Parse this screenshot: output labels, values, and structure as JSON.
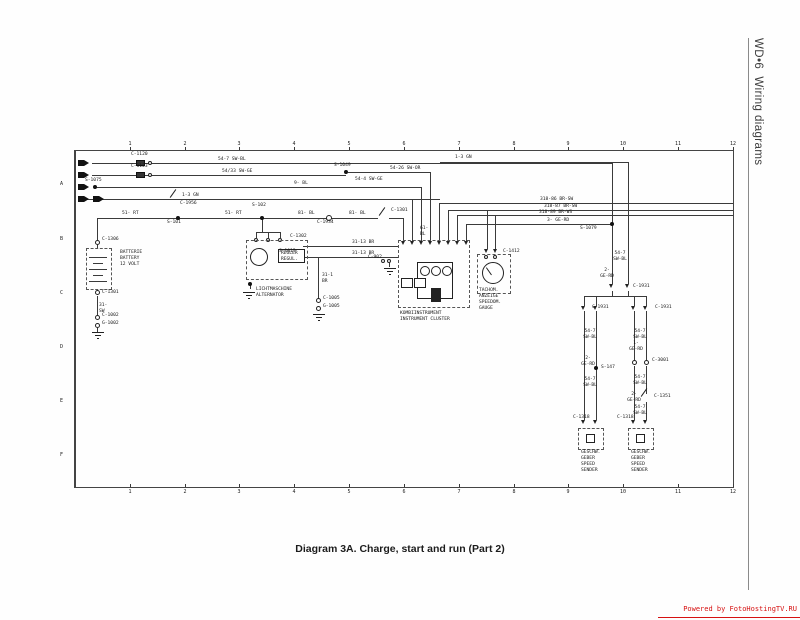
{
  "page": {
    "sidebar_title": "WD•6  Wiring diagrams",
    "caption": "Diagram 3A. Charge, start and run (Part 2)",
    "watermark": "Powered by FotoHostingTV.RU"
  },
  "grid": {
    "cols": [
      "1",
      "2",
      "3",
      "4",
      "5",
      "6",
      "7",
      "8",
      "9",
      "10",
      "11",
      "12"
    ],
    "rows": [
      "A",
      "B",
      "C",
      "D",
      "E",
      "F"
    ]
  },
  "labels": [
    "C-1120",
    "C-1123",
    "S-1075",
    "54-7 SW-BL",
    "54/33 SW-GE",
    "9- BL",
    "1-3 GN",
    "C-1956",
    "1-3 GN",
    "S-1049",
    "54-26 SW-OR",
    "54-4 SW-GE",
    "51- RT",
    "S-101",
    "51- RT",
    "S-102",
    "81- BL",
    "C-1934",
    "81- BL",
    "C-1301",
    "61-\nBL",
    "31-13 BR",
    "31-13 BR",
    "S-1015",
    "31-1\nBR",
    "C-1005",
    "G-1005",
    "C-1306",
    "BATTERIE\nBATTERY\n12 VOLT",
    "C-1301",
    "31-\nSW",
    "C-1002",
    "G-1002",
    "C-1302",
    "REGLER\nREGUL.",
    "LICHTMASCHINE\nALTERNATOR",
    "C-902",
    "KOMBIINSTRUMENT\nINSTRUMENT CLUSTER",
    "C-1412",
    "TACHOM.\nANZEIGE\nSPEEDOM.\nGAUGE",
    "318-86 BR-SW",
    "318-87 BR-SW",
    "318-89 BR-WS",
    "3- GE-RD",
    "S-1079",
    "54-7\nSW-BL",
    "2-\nGE-RD",
    "C-1931",
    "C-1931",
    "C-1931",
    "54-7\nSW-BL",
    "2-\nGE-RD",
    "S-147",
    "54-7\nSW-BL",
    "C-1318",
    "GESCHW.\nGEBER\nSPEED\nSENDER",
    "54-7\nSW-BL",
    "1-\nGE-RD",
    "C-3001",
    "54-7\nSW-BL",
    "2-\nGE-RD",
    "C-1351",
    "54-7\nSW-BL",
    "C-1318",
    "GESCHW.\nGEBER\nSPEED\nSENDER"
  ],
  "colors": {
    "ink": "#1a1a1a",
    "watermark_red": "#d61111"
  }
}
